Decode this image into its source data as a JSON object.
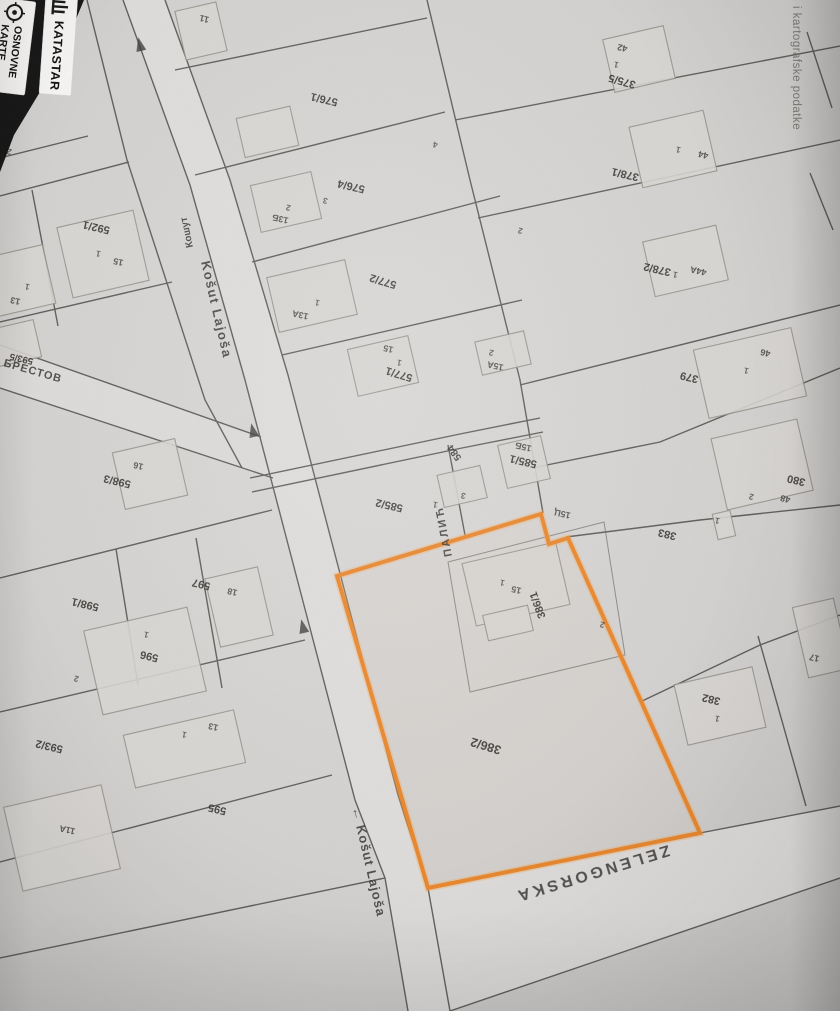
{
  "app": {
    "brand": {
      "label": "KATASTAR",
      "icon": "cadastre-columns-icon"
    },
    "nav": {
      "words": [
        "OSNOVNE",
        "KARTE"
      ],
      "icon": "target-icon"
    }
  },
  "attribution": "i kartografske podatke",
  "map": {
    "highlight_color": "#e8872f",
    "selected_parcel": "386/2",
    "street_labels": [
      {
        "text": "Košut Lajoša"
      },
      {
        "text": "← Košut Lajoša"
      },
      {
        "text": "Кошут"
      },
      {
        "text": "ПАЛИЋ"
      },
      {
        "text": "ZELENGORSKA"
      },
      {
        "text": "БРЕСТОВ"
      }
    ],
    "parcels": [
      {
        "text": "592/1"
      },
      {
        "text": "593/5"
      },
      {
        "text": "598/3"
      },
      {
        "text": "597"
      },
      {
        "text": "598/1"
      },
      {
        "text": "596"
      },
      {
        "text": "593/2"
      },
      {
        "text": "595"
      },
      {
        "text": "576/1"
      },
      {
        "text": "576/4"
      },
      {
        "text": "577/2"
      },
      {
        "text": "577/1"
      },
      {
        "text": "584"
      },
      {
        "text": "585/1"
      },
      {
        "text": "585/2"
      },
      {
        "text": "386/1"
      },
      {
        "text": "386/2"
      },
      {
        "text": "375/5"
      },
      {
        "text": "378/1"
      },
      {
        "text": "378/2"
      },
      {
        "text": "379"
      },
      {
        "text": "380"
      },
      {
        "text": "383"
      },
      {
        "text": "382"
      }
    ],
    "houses": [
      {
        "text": "11"
      },
      {
        "text": "15"
      },
      {
        "text": "13"
      },
      {
        "text": "16"
      },
      {
        "text": "18"
      },
      {
        "text": "13"
      },
      {
        "text": "11A"
      },
      {
        "text": "13Б"
      },
      {
        "text": "13A"
      },
      {
        "text": "15"
      },
      {
        "text": "15A"
      },
      {
        "text": "15Б"
      },
      {
        "text": "15Ц"
      },
      {
        "text": "15"
      },
      {
        "text": "42"
      },
      {
        "text": "44"
      },
      {
        "text": "44A"
      },
      {
        "text": "46"
      },
      {
        "text": "48"
      },
      {
        "text": "17"
      }
    ],
    "marks": [
      {
        "text": "2"
      },
      {
        "text": "2"
      },
      {
        "text": "3"
      },
      {
        "text": "4"
      },
      {
        "text": "2"
      },
      {
        "text": "2"
      },
      {
        "text": "1"
      },
      {
        "text": "1"
      },
      {
        "text": "1"
      },
      {
        "text": "1"
      },
      {
        "text": "1"
      },
      {
        "text": "1"
      },
      {
        "text": "1"
      },
      {
        "text": "1"
      },
      {
        "text": "1"
      },
      {
        "text": "1"
      },
      {
        "text": "1"
      },
      {
        "text": "1"
      },
      {
        "text": "1"
      },
      {
        "text": "3"
      },
      {
        "text": "2"
      },
      {
        "text": "2"
      },
      {
        "text": "2"
      },
      {
        "text": "1"
      }
    ]
  }
}
